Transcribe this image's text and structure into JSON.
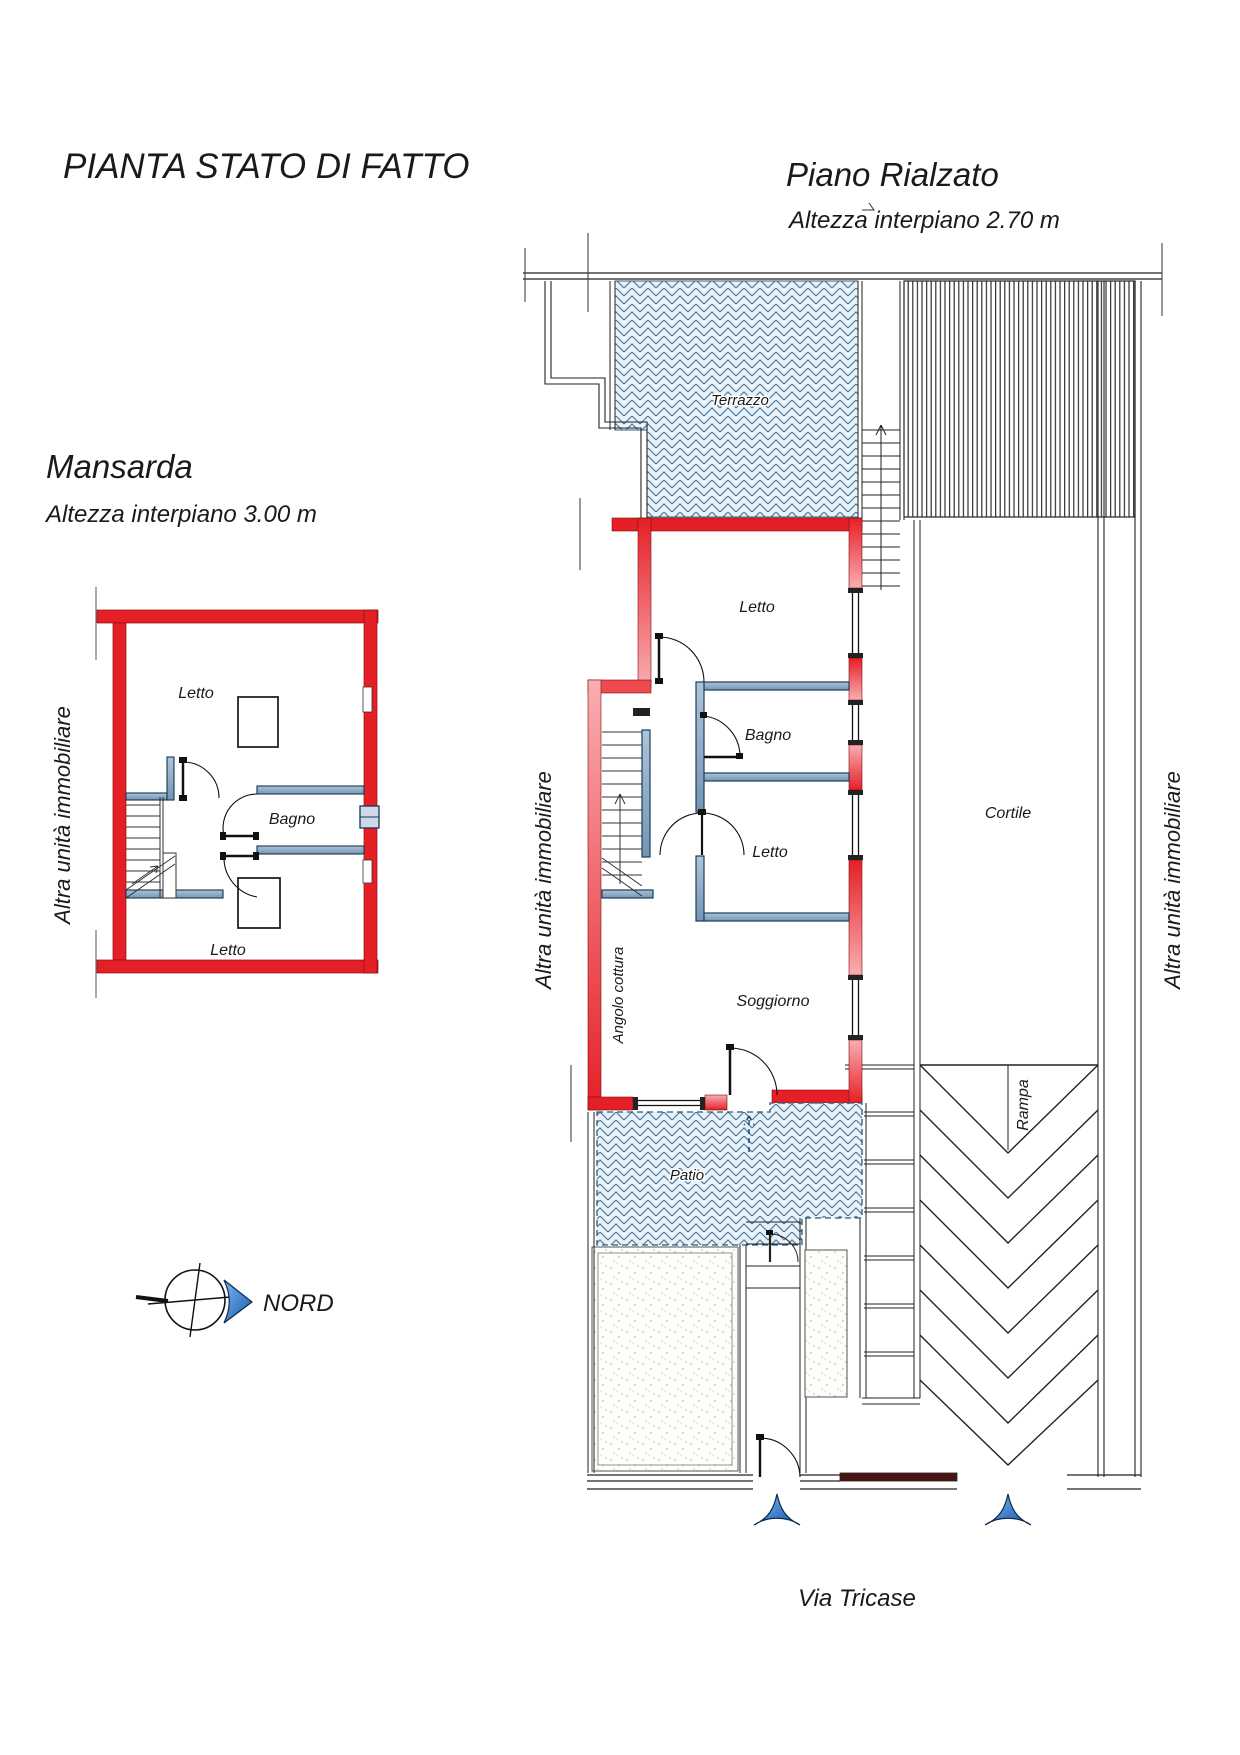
{
  "header": {
    "title": "PIANTA STATO DI FATTO"
  },
  "mansarda": {
    "title": "Mansarda",
    "subtitle": "Altezza interpiano 3.00 m",
    "rooms": {
      "letto_top": "Letto",
      "bagno": "Bagno",
      "letto_bottom": "Letto"
    }
  },
  "rialzato": {
    "title": "Piano Rialzato",
    "subtitle": "Altezza interpiano 2.70 m",
    "rooms": {
      "terrazzo": "Terrazzo",
      "letto_top": "Letto",
      "bagno": "Bagno",
      "letto_mid": "Letto",
      "soggiorno": "Soggiorno",
      "angolo_cottura": "Angolo cottura",
      "cortile": "Cortile",
      "rampa": "Rampa",
      "patio": "Patio"
    }
  },
  "annotations": {
    "adjacent_unit": "Altra unità immobiliare",
    "north": "NORD",
    "street": "Via Tricase"
  },
  "colors": {
    "wall_red": "#e51f26",
    "wall_red_light": "#f9aeb2",
    "partition_blue": "#8aa6c0",
    "hatch_blue": "#4f7d9e",
    "arrow_blue": "#2a77d4",
    "gate_brown": "#4a1512"
  }
}
